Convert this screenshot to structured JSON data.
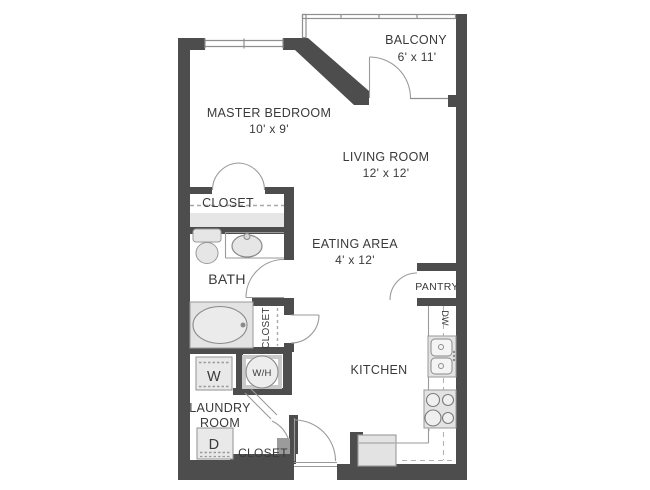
{
  "plan": {
    "title": "Studio apartment floor plan",
    "rooms": {
      "master_bedroom": {
        "label": "MASTER BEDROOM",
        "dims": "10' x 9'"
      },
      "balcony": {
        "label": "BALCONY",
        "dims": "6' x 11'"
      },
      "living_room": {
        "label": "LIVING ROOM",
        "dims": "12' x 12'"
      },
      "eating_area": {
        "label": "EATING AREA",
        "dims": "4' x 12'"
      },
      "kitchen": {
        "label": "KITCHEN"
      },
      "bath": {
        "label": "BATH"
      },
      "pantry": {
        "label": "PANTRY"
      },
      "laundry_room": {
        "label_line1": "LAUNDRY",
        "label_line2": "ROOM"
      },
      "master_closet": {
        "label": "CLOSET"
      },
      "hall_closet": {
        "label": "CLOSET"
      },
      "entry_closet": {
        "label": "CLOSET"
      }
    },
    "fixtures": {
      "washer": "W",
      "dryer": "D",
      "water_heater": "W/H",
      "dishwasher": "DW"
    },
    "colors": {
      "wall": "#4d4d4d",
      "thin_line": "#8f8f8f",
      "fixture_fill": "#e6e6e6",
      "text": "#3a3a3a",
      "background": "#ffffff"
    }
  }
}
